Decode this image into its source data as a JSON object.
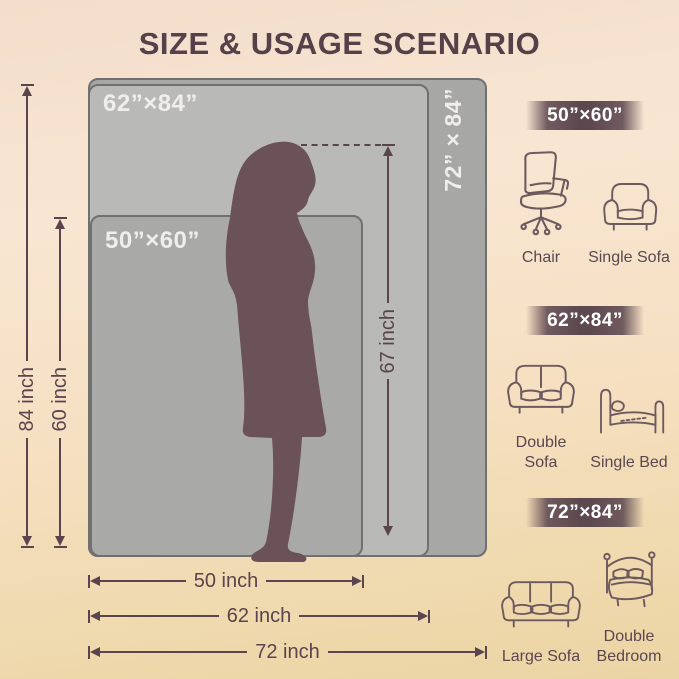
{
  "title": "SIZE & USAGE SCENARIO",
  "diagram": {
    "rects": {
      "r72": {
        "label": "72”×84”"
      },
      "r62": {
        "label": "62”×84”"
      },
      "r50": {
        "label": "50”×60”"
      }
    },
    "arrows": {
      "h84": "84 inch",
      "h60": "60 inch",
      "h67": "67 inch",
      "w50": "50 inch",
      "w62": "62 inch",
      "w72": "72 inch"
    },
    "figure": "woman-silhouette"
  },
  "scenarios": [
    {
      "size": "50”×60”",
      "items": [
        {
          "icon": "office-chair-icon",
          "label": "Chair"
        },
        {
          "icon": "single-sofa-icon",
          "label": "Single Sofa"
        }
      ]
    },
    {
      "size": "62”×84”",
      "items": [
        {
          "icon": "double-sofa-icon",
          "label": "Double Sofa"
        },
        {
          "icon": "single-bed-icon",
          "label": "Single Bed"
        }
      ]
    },
    {
      "size": "72”×84”",
      "items": [
        {
          "icon": "large-sofa-icon",
          "label": "Large Sofa"
        },
        {
          "icon": "double-bed-icon",
          "label": "Double Bedroom"
        }
      ]
    }
  ],
  "colors": {
    "ink": "#5a444e",
    "title": "#564049",
    "badge": "#5e4850",
    "rect_72": "#a7a7a5",
    "rect_62": "#b9b9b7",
    "rect_50": "#a9a9a7",
    "rect_border": "#70706e",
    "rect_label": "#efeeec",
    "silhouette": "#6b5158",
    "bg_top": "#f3ddcc",
    "bg_bottom": "#ebd4a4"
  }
}
